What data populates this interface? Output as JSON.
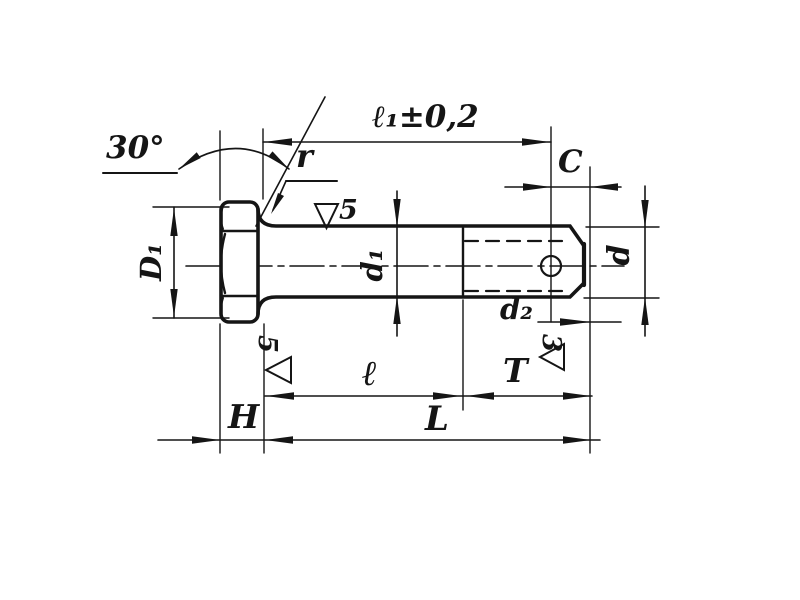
{
  "drawing": {
    "type": "technical drawing of hex-head bolt with cotter-pin hole",
    "angle_label": "30°",
    "fillet_label": "r",
    "pin_hole_distance_label": "ℓ₁±0,2",
    "chamfer_label": "C",
    "head_diameter_label": "D₁",
    "shank_diameter_label": "d₁",
    "end_diameter_label": "d",
    "hole_diameter_label": "d₂",
    "head_height_label": "H",
    "grip_length_label": "ℓ",
    "thread_length_label": "T",
    "overall_length_label": "L",
    "surface_finish": {
      "shank_value": "5",
      "head_face_value": "5",
      "end_value": "3"
    }
  }
}
